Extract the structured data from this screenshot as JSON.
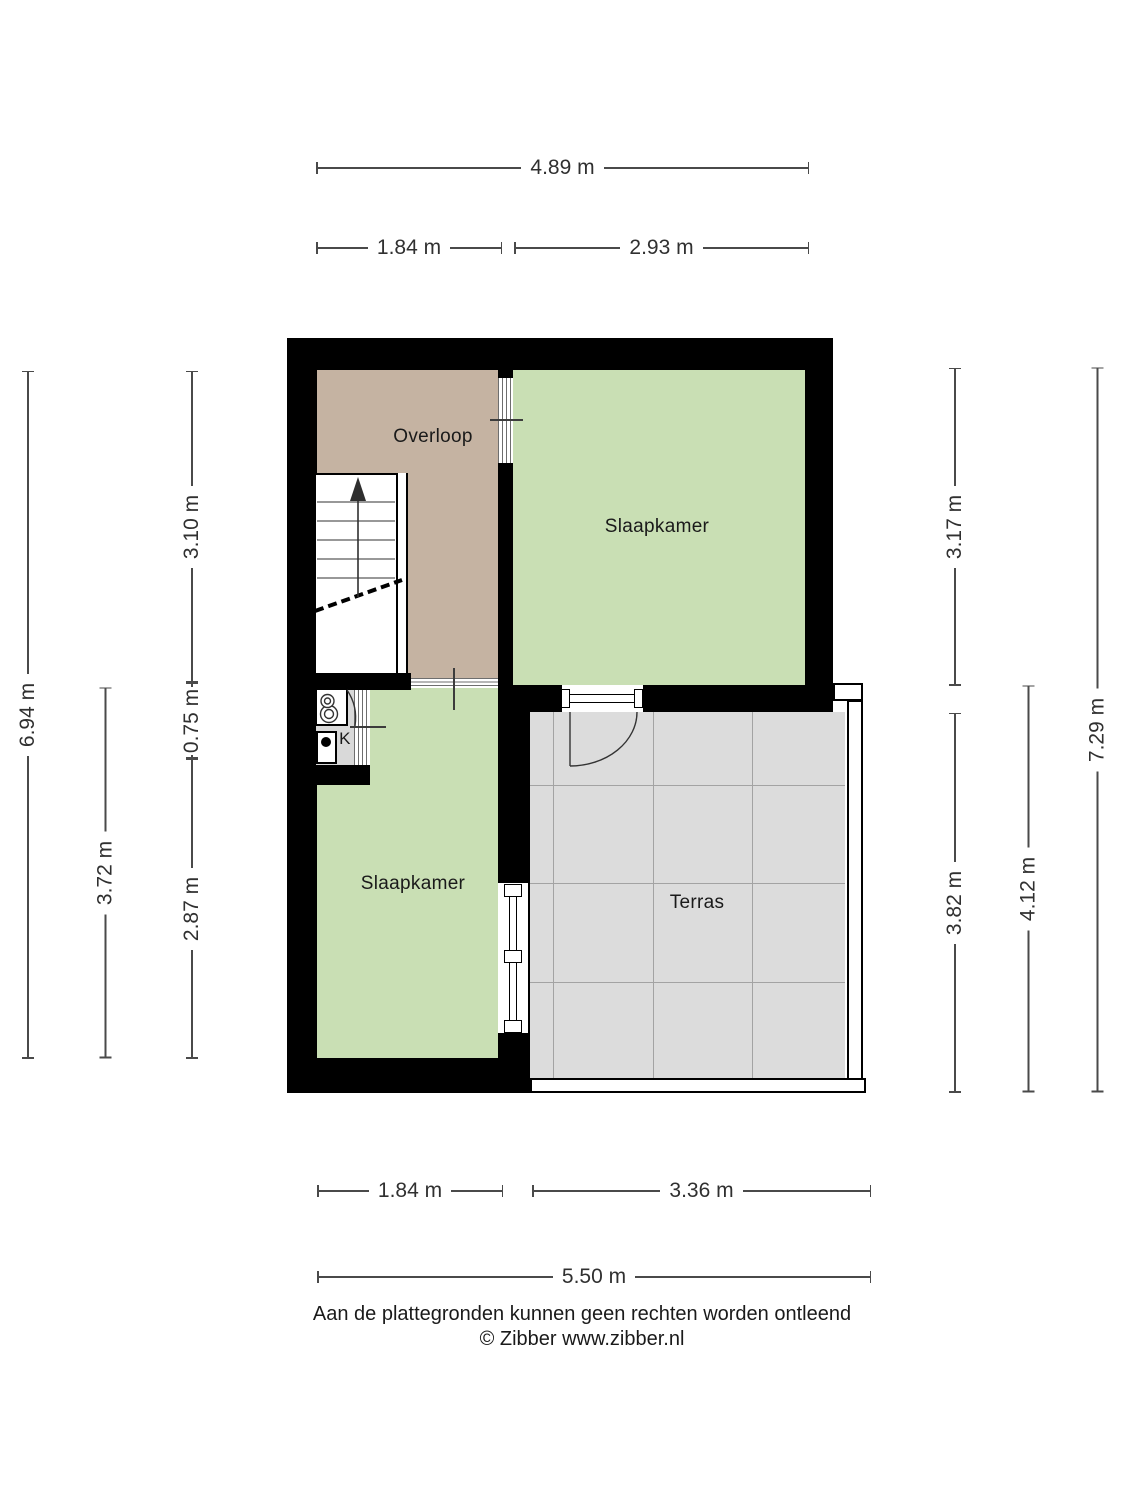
{
  "floorplan": {
    "rooms": {
      "overloop": "Overloop",
      "slaapkamer_top": "Slaapkamer",
      "slaapkamer_bottom": "Slaapkamer",
      "terras": "Terras",
      "kitchen": "K"
    },
    "dims": {
      "top_total": "4.89 m",
      "top_left": "1.84 m",
      "top_right": "2.93 m",
      "bottom_left": "1.84 m",
      "bottom_right": "3.36 m",
      "bottom_total": "5.50 m",
      "left_total": "6.94 m",
      "left_lower": "3.72 m",
      "left_seg1": "3.10 m",
      "left_seg2": "0.75 m",
      "left_seg3": "2.87 m",
      "right_seg1": "3.17 m",
      "right_seg2": "3.82 m",
      "right_lower": "4.12 m",
      "right_total": "7.29 m"
    },
    "footer": {
      "disclaimer": "Aan de plattegronden kunnen geen rechten worden ontleend",
      "copyright": "© Zibber www.zibber.nl"
    },
    "colors": {
      "wall": "#000000",
      "room_green": "#c9dfb4",
      "room_tan": "#c5b3a2",
      "terrace_gray": "#dcdcdc",
      "kitchen_gray": "#d9d9d9"
    }
  }
}
